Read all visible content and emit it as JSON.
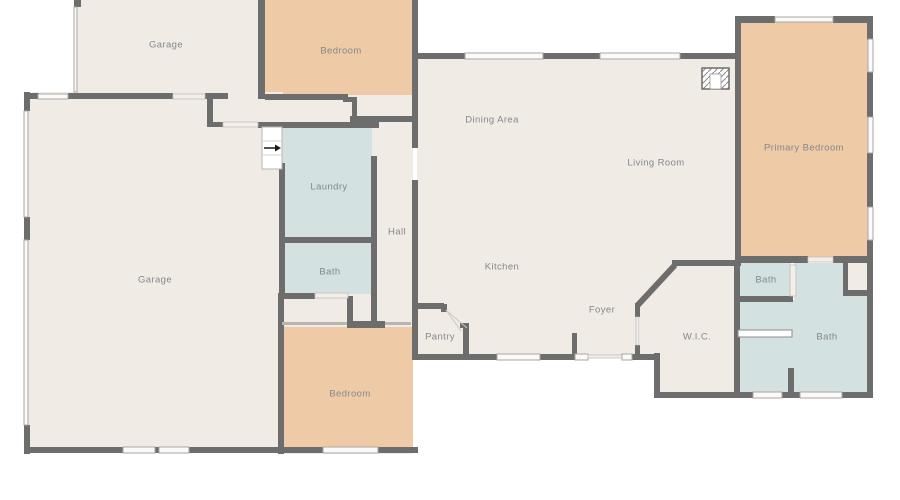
{
  "palette": {
    "cream": "#f1ebe6",
    "tan": "#eecaa6",
    "blue": "#d4e1e1",
    "wall": "#6e6d6d",
    "label": "#84888b",
    "window": "#fbfaf8",
    "background": "#ffffff"
  },
  "rooms": [
    {
      "id": "garage-upper",
      "label": "Garage",
      "x": 166,
      "y": 45,
      "fill": "cream"
    },
    {
      "id": "bedroom-upper",
      "label": "Bedroom",
      "x": 341,
      "y": 51,
      "fill": "tan"
    },
    {
      "id": "garage-main",
      "label": "Garage",
      "x": 155,
      "y": 280,
      "fill": "cream"
    },
    {
      "id": "laundry",
      "label": "Laundry",
      "x": 329,
      "y": 187,
      "fill": "blue"
    },
    {
      "id": "hall",
      "label": "Hall",
      "x": 397,
      "y": 232,
      "fill": "cream"
    },
    {
      "id": "bath-hall",
      "label": "Bath",
      "x": 330,
      "y": 272,
      "fill": "blue"
    },
    {
      "id": "bedroom-lower",
      "label": "Bedroom",
      "x": 350,
      "y": 394,
      "fill": "tan"
    },
    {
      "id": "dining-area",
      "label": "Dining Area",
      "x": 492,
      "y": 120,
      "fill": "cream"
    },
    {
      "id": "living-room",
      "label": "Living Room",
      "x": 656,
      "y": 163,
      "fill": "cream"
    },
    {
      "id": "kitchen",
      "label": "Kitchen",
      "x": 502,
      "y": 267,
      "fill": "cream"
    },
    {
      "id": "pantry",
      "label": "Pantry",
      "x": 440,
      "y": 337,
      "fill": "cream"
    },
    {
      "id": "foyer",
      "label": "Foyer",
      "x": 602,
      "y": 310,
      "fill": "cream"
    },
    {
      "id": "primary-bedroom",
      "label": "Primary Bedroom",
      "x": 804,
      "y": 148,
      "fill": "tan"
    },
    {
      "id": "wic",
      "label": "W.I.C.",
      "x": 697,
      "y": 337,
      "fill": "cream"
    },
    {
      "id": "bath-small",
      "label": "Bath",
      "x": 766,
      "y": 280,
      "fill": "blue"
    },
    {
      "id": "bath-primary",
      "label": "Bath",
      "x": 827,
      "y": 337,
      "fill": "blue"
    }
  ],
  "fixtures": {
    "stairs_arrow_direction": "right"
  }
}
